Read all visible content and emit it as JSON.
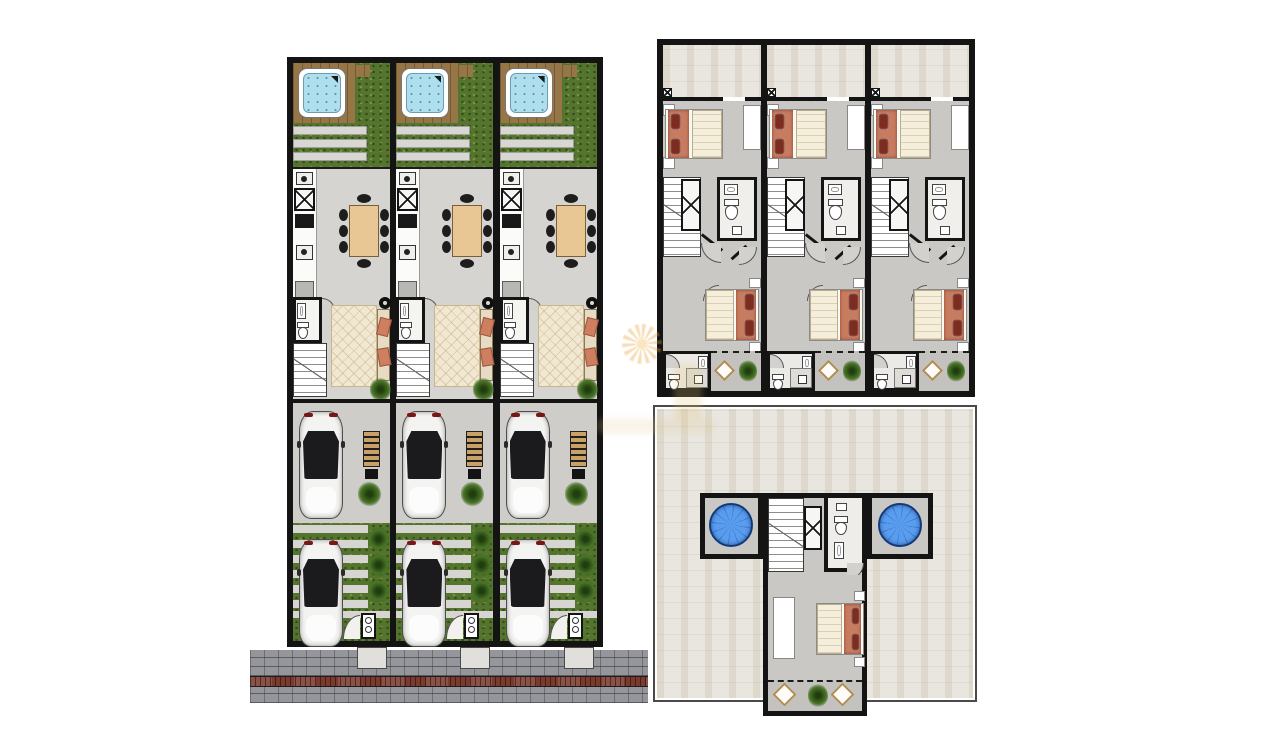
{
  "scene": {
    "type": "architectural-floor-plan-sheet",
    "description": "Floor plans of a three-townhouse development: ground floor with jacuzzi deck, garden, kitchen-dining, living room and two-car driveway; first floor with two bedrooms, bathrooms and terrace; roof solarium with two plunge pools, bedroom and lounge balcony",
    "background": "#ffffff",
    "text_labels": []
  },
  "plans": [
    {
      "id": "ground",
      "name": "ground-floor-plan",
      "units": 3
    },
    {
      "id": "first",
      "name": "first-floor-plan",
      "units": 3
    },
    {
      "id": "roof",
      "name": "roof-solarium-plan",
      "units": 1
    }
  ],
  "unit_features": {
    "ground": [
      "jacuzzi",
      "timber-deck",
      "garden",
      "walkway-strips",
      "kitchen-counter",
      "dining-table-8-chairs",
      "guest-toilet",
      "staircase",
      "living-room-sofa-rug",
      "floor-lamp",
      "garage-car",
      "storage-shelf",
      "driveway-car",
      "grass-paver-strips",
      "entrance-gate",
      "porch"
    ],
    "first": [
      "terrace",
      "bedroom-1-double-bed",
      "wardrobe",
      "staircase",
      "bathroom",
      "bedroom-2-double-bed",
      "shower-bathroom",
      "balcony-with-plant"
    ],
    "roof": [
      "plunge-pool-left",
      "plunge-pool-right",
      "staircase",
      "bathroom",
      "bedroom-double-bed",
      "wardrobe",
      "lounge-balcony-two-chairs",
      "roof-terrace"
    ]
  },
  "watermark": {
    "present": true,
    "icon": "sun-spiral-logo",
    "color": "#e5a034"
  },
  "colors": {
    "paper": "#ffffff",
    "wall": "#141414",
    "floor": "#d5d4d1",
    "floor2": "#cecdc9",
    "floor3": "#c9c8c5",
    "balc": "#c3c2bf",
    "garden": "#55752e",
    "plant": "#4a7527",
    "plantdark": "#1f3d0e",
    "deck": "#967547",
    "water": "#aedfee",
    "walkway": "#d8d7d3",
    "wood": "#e9c795",
    "cushion": "#cd7f5f",
    "rug": "#f0e8d2",
    "car": "#f3f3f1",
    "glass": "#1b1b1e",
    "sidewalk": "#94969b",
    "curb": "#7c392d",
    "porch": "#e0dfdc",
    "terrace": "#e9e6e0",
    "duvet": "#f4eeda",
    "blanket": "#c87c5f",
    "pillow": "#7c2d20",
    "doorfill": "#d2d1cd"
  }
}
